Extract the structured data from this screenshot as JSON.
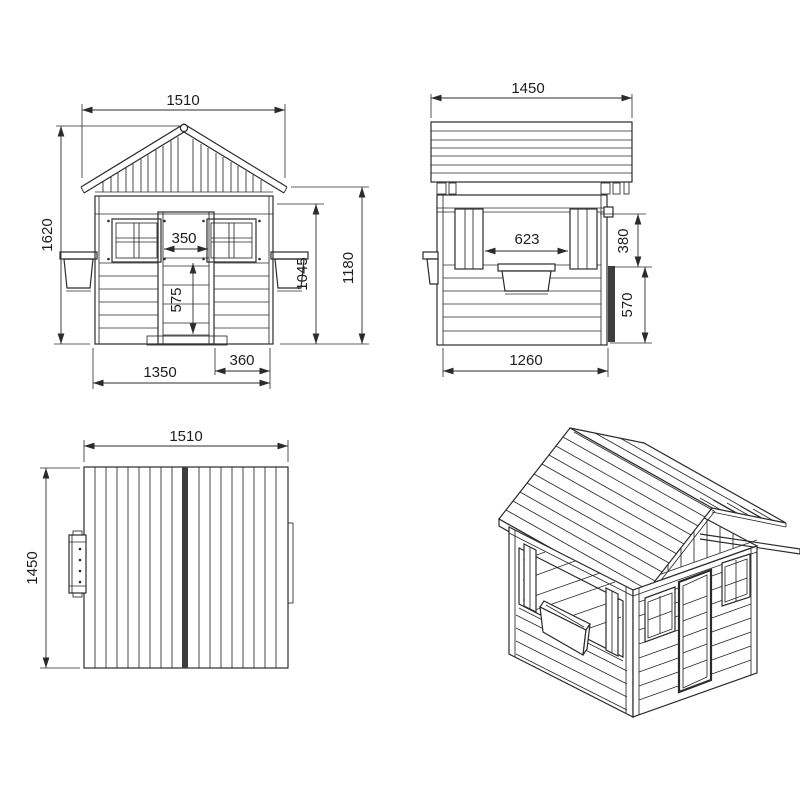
{
  "drawing": {
    "background": "#ffffff",
    "line_color": "#2b2b2b",
    "views": {
      "front": {
        "dims": {
          "total_width": "1510",
          "total_height": "1620",
          "door_width": "350",
          "door_height": "575",
          "wall_height": "1045",
          "eaves_height": "1180",
          "base_width": "1350",
          "door_side_offset": "360"
        }
      },
      "side": {
        "dims": {
          "roof_length": "1450",
          "opening_width": "623",
          "opening_height": "380",
          "lower_wall_height": "570",
          "base_length": "1260"
        }
      },
      "top": {
        "dims": {
          "width": "1510",
          "depth": "1450"
        }
      }
    }
  }
}
